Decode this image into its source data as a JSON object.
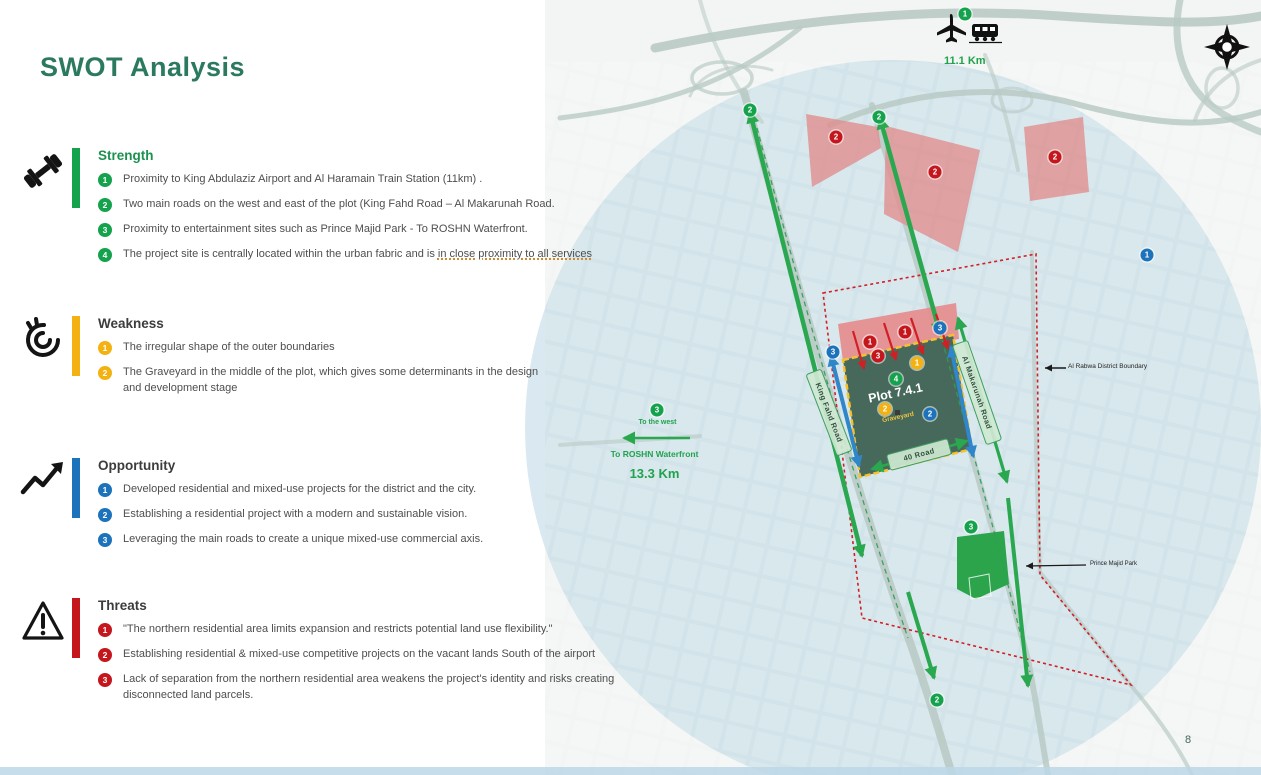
{
  "page": {
    "title": "SWOT Analysis",
    "page_number": "8"
  },
  "colors": {
    "green": "#14a24c",
    "yellow": "#f3b211",
    "blue": "#1c73bb",
    "red": "#c4161c",
    "title_green": "#2b7a5e",
    "plot_green": "#46695c",
    "pink": "#e08f8f",
    "circle_blue": "#a8cade"
  },
  "sections": [
    {
      "title": "Strength",
      "icon": "dumbbell-icon",
      "color": "#14a24c",
      "items": [
        {
          "n": "1",
          "text": "Proximity to King Abdulaziz Airport and Al Haramain Train Station (11km) ."
        },
        {
          "n": "2",
          "text": "Two main roads on the west and east of the plot (King Fahd Road – Al Makarunah Road."
        },
        {
          "n": "3",
          "text": "Proximity to entertainment sites such as Prince Majid Park - To ROSHN Waterfront."
        },
        {
          "n": "4",
          "text": "The project site is centrally located within the urban fabric and is ",
          "underlined": "in close proximity to all services"
        }
      ]
    },
    {
      "title": "Weakness",
      "icon": "confused-face-icon",
      "color": "#f3b211",
      "items": [
        {
          "n": "1",
          "text": "The irregular shape of the outer boundaries"
        },
        {
          "n": "2",
          "text": "The Graveyard in the middle of the plot, which gives some determinants in the design and development stage"
        }
      ]
    },
    {
      "title": "Opportunity",
      "icon": "trend-up-icon",
      "color": "#1c73bb",
      "items": [
        {
          "n": "1",
          "text": "Developed residential and mixed-use projects for the district and the city."
        },
        {
          "n": "2",
          "text": "Establishing a residential project with a modern and sustainable vision."
        },
        {
          "n": "3",
          "text": "Leveraging the main roads to create a unique mixed-use commercial axis."
        }
      ]
    },
    {
      "title": "Threats",
      "icon": "warning-triangle-icon",
      "color": "#c4161c",
      "items": [
        {
          "n": "1",
          "text": "\"The northern residential area limits expansion and restricts potential land use flexibility.\""
        },
        {
          "n": "2",
          "text": "Establishing residential & mixed-use competitive projects on the vacant lands South of the airport"
        },
        {
          "n": "3",
          "text": "Lack of separation from the northern residential area weakens the project's identity and risks creating disconnected land parcels."
        }
      ]
    }
  ],
  "map": {
    "airport_distance": "11.1 Km",
    "west_direction": "To the west",
    "waterfront": "To ROSHN Waterfront",
    "waterfront_distance": "13.3 Km",
    "plot": "Plot 7.4.1",
    "graveyard": "Graveyard",
    "road_king_fahd": "King Fahd Road",
    "road_al_makarunah": "Al Makarunah Road",
    "road_40": "40 Road",
    "district_boundary": "Al Rabwa District Boundary",
    "park": "Prince Majid Park",
    "badges": [
      {
        "n": "1",
        "color": "green"
      },
      {
        "n": "2",
        "color": "green"
      },
      {
        "n": "2",
        "color": "green"
      },
      {
        "n": "2",
        "color": "red"
      },
      {
        "n": "2",
        "color": "red"
      },
      {
        "n": "2",
        "color": "red"
      },
      {
        "n": "1",
        "color": "blue"
      },
      {
        "n": "3",
        "color": "green"
      },
      {
        "n": "3",
        "color": "blue"
      },
      {
        "n": "3",
        "color": "blue"
      },
      {
        "n": "1",
        "color": "red"
      },
      {
        "n": "1",
        "color": "red"
      },
      {
        "n": "3",
        "color": "red"
      },
      {
        "n": "1",
        "color": "yellow"
      },
      {
        "n": "4",
        "color": "green"
      },
      {
        "n": "2",
        "color": "yellow"
      },
      {
        "n": "2",
        "color": "blue"
      },
      {
        "n": "3",
        "color": "green"
      },
      {
        "n": "2",
        "color": "green"
      }
    ]
  }
}
